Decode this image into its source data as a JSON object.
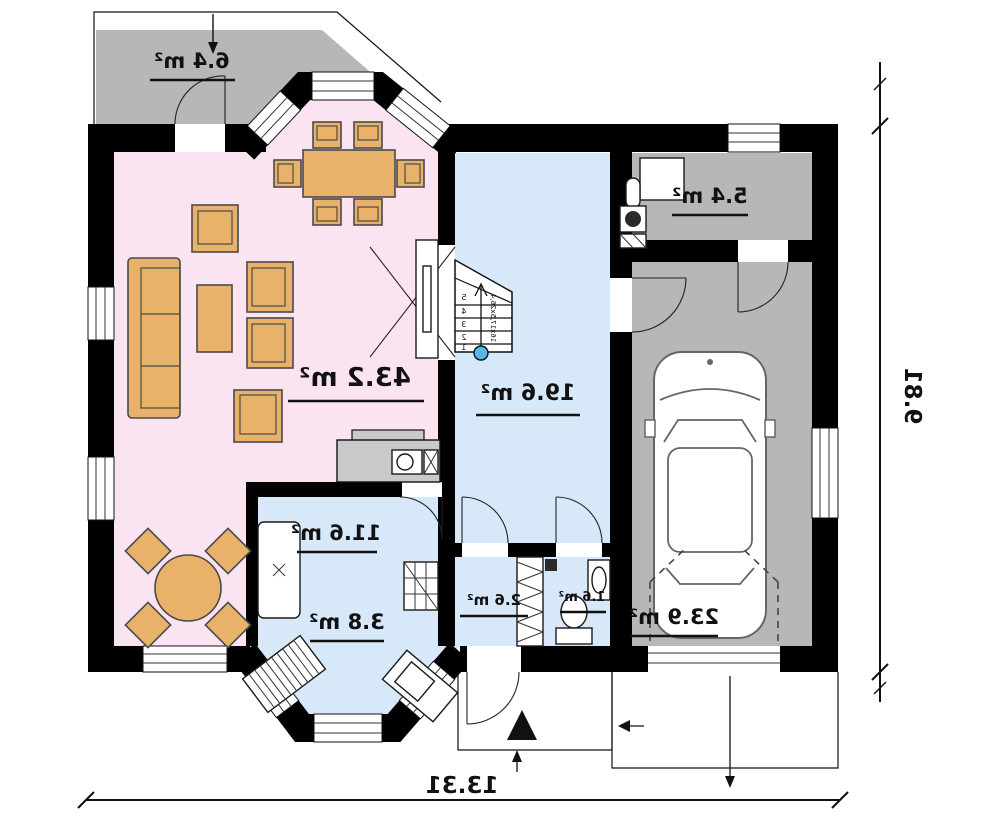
{
  "rooms": {
    "terrace": {
      "name": "terrace",
      "label": "6.4 m²"
    },
    "living_dining": {
      "name": "living-dining",
      "label": "43.2 m²"
    },
    "hall": {
      "name": "hall-stairs",
      "label": "19.6 m²"
    },
    "kitchen": {
      "name": "kitchen",
      "label": "11.6 m²"
    },
    "kitchen_bay": {
      "name": "kitchen-bay",
      "label": "3.8 m²"
    },
    "vestibule": {
      "name": "vestibule",
      "label": "2.6 m²"
    },
    "wc": {
      "name": "wc",
      "label": "1.6 m²"
    },
    "utility": {
      "name": "utility-room",
      "label": "5.4 m²"
    },
    "garage": {
      "name": "garage",
      "label": "23.9 m²"
    }
  },
  "dimensions": {
    "overall_width": "13.31",
    "overall_height": "9.81"
  },
  "stairs": {
    "steps": [
      "1",
      "2",
      "3",
      "4",
      "5"
    ],
    "note": "16x17,5x26,4"
  },
  "colors": {
    "wall": "#000000",
    "living": "#fae4f1",
    "wet_rooms": "#d7e8f8",
    "paved": "#b7b7b7",
    "furniture": "#e9b26a",
    "stair_start_dot": "#53b7ea"
  },
  "note": "floor plan rendered mirrored (all labels read right-to-left as in source)"
}
